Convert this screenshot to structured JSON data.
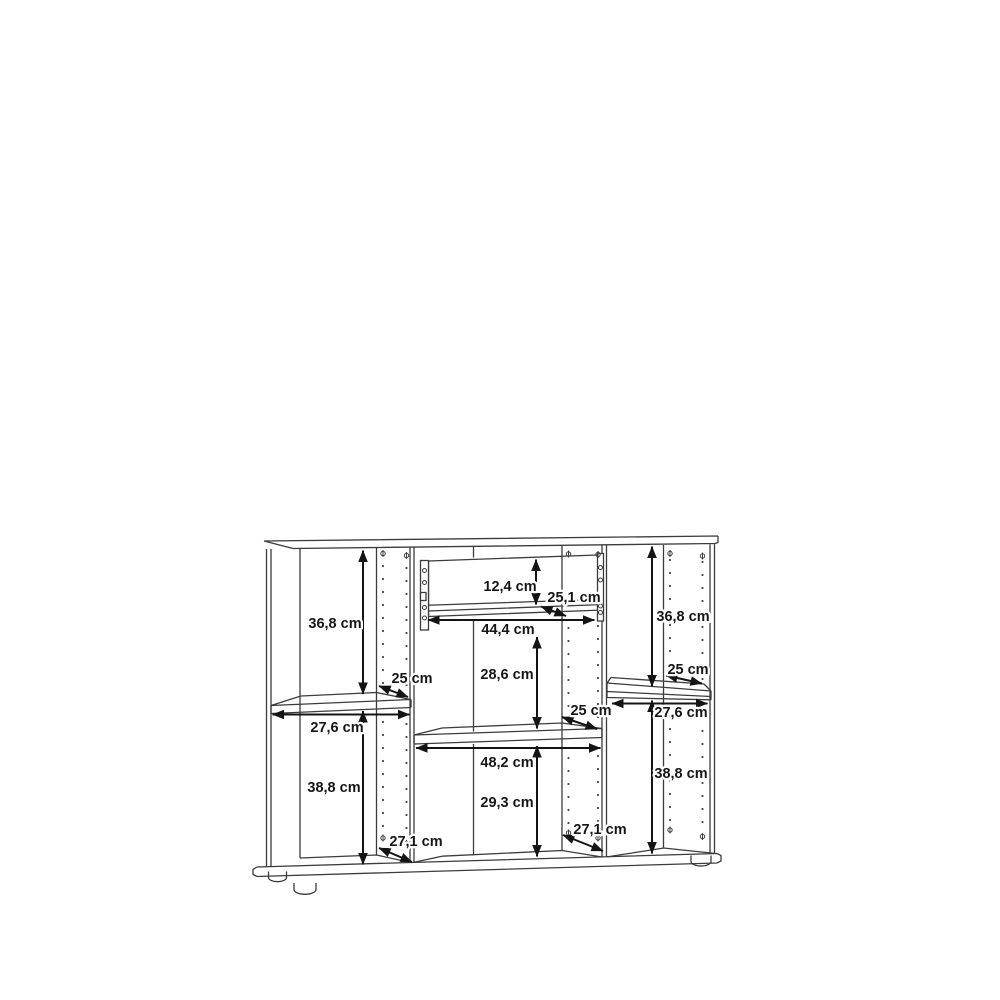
{
  "page": {
    "background": "#ffffff"
  },
  "drawing": {
    "kind": "furniture-internal-dimension-diagram",
    "object": "sideboard cabinet with three compartments, adjustable shelves and one interior drawer",
    "unit": "cm",
    "colors": {
      "background": "#ffffff",
      "structure_line": "#3c3c3c",
      "dimension_line": "#141414",
      "label_text": "#161616"
    },
    "dimensions": [
      {
        "id": "left-upper-height",
        "section": "left",
        "text": "36,8 cm",
        "value_cm": 36.8,
        "x": 335,
        "y": 628
      },
      {
        "id": "drawer-inner-height",
        "section": "center",
        "text": "12,4 cm",
        "value_cm": 12.4,
        "x": 510,
        "y": 591
      },
      {
        "id": "drawer-depth",
        "section": "center",
        "text": "25,1 cm",
        "value_cm": 25.1,
        "x": 574,
        "y": 602
      },
      {
        "id": "right-upper-height",
        "section": "right",
        "text": "36,8 cm",
        "value_cm": 36.8,
        "x": 683,
        "y": 621
      },
      {
        "id": "drawer-inner-width",
        "section": "center",
        "text": "44,4 cm",
        "value_cm": 44.4,
        "x": 508,
        "y": 634
      },
      {
        "id": "left-shelf-depth",
        "section": "left",
        "text": "25 cm",
        "value_cm": 25,
        "x": 412,
        "y": 683
      },
      {
        "id": "center-upper-height",
        "section": "center",
        "text": "28,6 cm",
        "value_cm": 28.6,
        "x": 507,
        "y": 679
      },
      {
        "id": "right-shelf-depth",
        "section": "right",
        "text": "25 cm",
        "value_cm": 25,
        "x": 688,
        "y": 674
      },
      {
        "id": "left-inner-width",
        "section": "left",
        "text": "27,6 cm",
        "value_cm": 27.6,
        "x": 337,
        "y": 732
      },
      {
        "id": "center-shelf-depth",
        "section": "center",
        "text": "25 cm",
        "value_cm": 25,
        "x": 591,
        "y": 715
      },
      {
        "id": "right-inner-width",
        "section": "right",
        "text": "27,6 cm",
        "value_cm": 27.6,
        "x": 681,
        "y": 717
      },
      {
        "id": "center-inner-width",
        "section": "center",
        "text": "48,2 cm",
        "value_cm": 48.2,
        "x": 507,
        "y": 767
      },
      {
        "id": "left-lower-height",
        "section": "left",
        "text": "38,8 cm",
        "value_cm": 38.8,
        "x": 334,
        "y": 792
      },
      {
        "id": "right-lower-height",
        "section": "right",
        "text": "38,8 cm",
        "value_cm": 38.8,
        "x": 681,
        "y": 778
      },
      {
        "id": "center-lower-height",
        "section": "center",
        "text": "29,3 cm",
        "value_cm": 29.3,
        "x": 507,
        "y": 807
      },
      {
        "id": "left-floor-depth",
        "section": "left",
        "text": "27,1 cm",
        "value_cm": 27.1,
        "x": 416,
        "y": 846
      },
      {
        "id": "right-floor-depth",
        "section": "right",
        "text": "27,1 cm",
        "value_cm": 27.1,
        "x": 600,
        "y": 834
      }
    ]
  }
}
